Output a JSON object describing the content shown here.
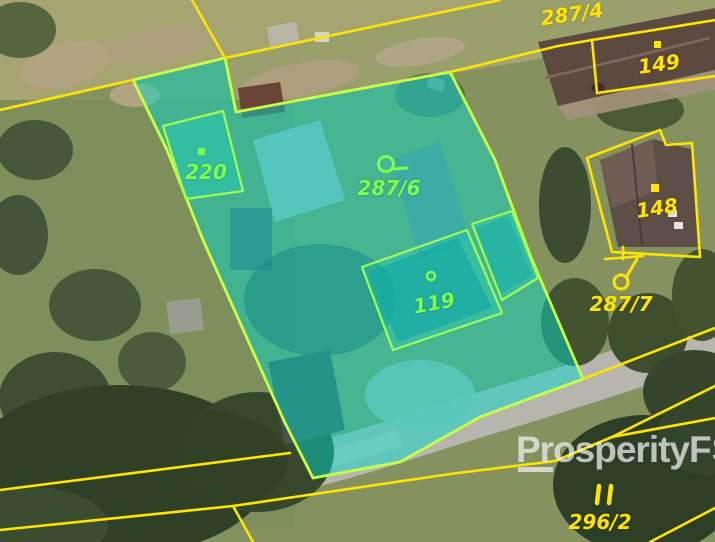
{
  "map": {
    "type": "cadastral-aerial-view",
    "parcels": {
      "p287_4": {
        "label": "287/4",
        "label_color": "#ffe400"
      },
      "p149": {
        "label": "149",
        "label_color": "#ffe400",
        "marker": "square-dot"
      },
      "p220": {
        "label": "220",
        "label_color": "#7dff4d",
        "marker": "square-dot"
      },
      "p287_6": {
        "label": "287/6",
        "label_color": "#7dff4d",
        "marker": "orchard-symbol"
      },
      "p148": {
        "label": "148",
        "label_color": "#ffe400",
        "marker": "square-dot"
      },
      "p119": {
        "label": "119",
        "label_color": "#7dff4d",
        "marker": "circle-dot"
      },
      "p287_7": {
        "label": "287/7",
        "label_color": "#ffe400",
        "marker": "orchard-symbol"
      },
      "p296_2": {
        "label": "296/2",
        "label_color": "#ffe400",
        "marker": "double-bar-symbol"
      }
    },
    "colors": {
      "parcel_line": "#ffe400",
      "highlight_fill": "#05dacb",
      "highlight_border": "#c9ff45",
      "inner_parcel_border": "#9fff50"
    }
  },
  "watermark": {
    "text": "ProsperityFS",
    "part1": "Prosperity",
    "part2": "FS"
  }
}
